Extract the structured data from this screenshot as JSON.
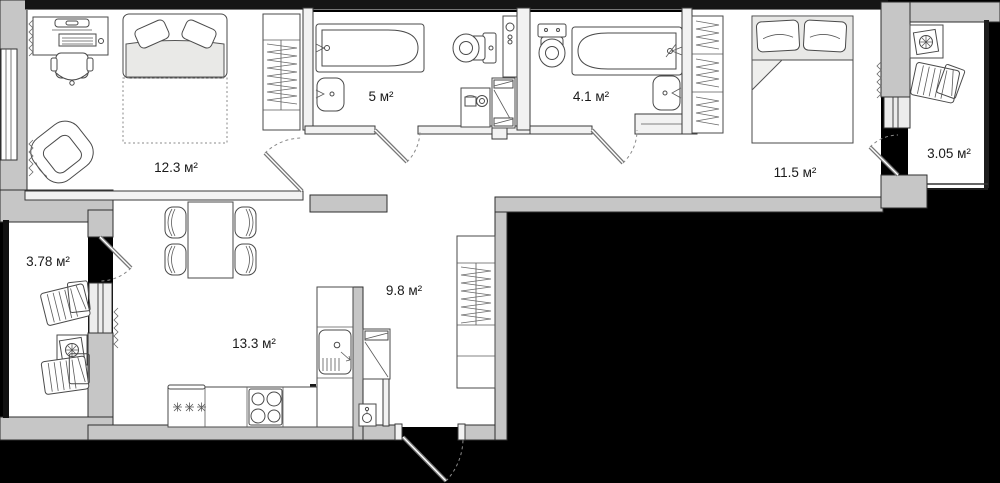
{
  "plan_type": "apartment-floor-plan",
  "colors": {
    "background": "#000000",
    "wall": "#c6c6c6",
    "wall_dark": "#161616",
    "floor": "#ffffff",
    "label_text": "#1a1a1a"
  },
  "rooms": [
    {
      "id": "living-room",
      "area_label": "12.3 м²"
    },
    {
      "id": "bathroom",
      "area_label": "5 м²"
    },
    {
      "id": "wc-bathroom",
      "area_label": "4.1 м²"
    },
    {
      "id": "bedroom",
      "area_label": "11.5 м²"
    },
    {
      "id": "balcony-right",
      "area_label": "3.05 м²"
    },
    {
      "id": "balcony-left",
      "area_label": "3.78 м²"
    },
    {
      "id": "hallway",
      "area_label": "9.8 м²"
    },
    {
      "id": "kitchen",
      "area_label": "13.3 м²"
    }
  ],
  "furniture_icons": [
    "desk-with-computer",
    "office-chair",
    "armchair",
    "sofa-bed",
    "wardrobe",
    "bathtub",
    "washbasin",
    "toilet",
    "washing-machine",
    "utility-shaft",
    "bath-cabinet",
    "double-bed",
    "closet-with-hangers",
    "dining-table",
    "dining-chair",
    "fridge",
    "stove",
    "kitchen-sink",
    "tall-cabinet",
    "water-heater",
    "hall-wardrobe",
    "deck-chair",
    "plant-table",
    "radiator",
    "door",
    "window"
  ]
}
